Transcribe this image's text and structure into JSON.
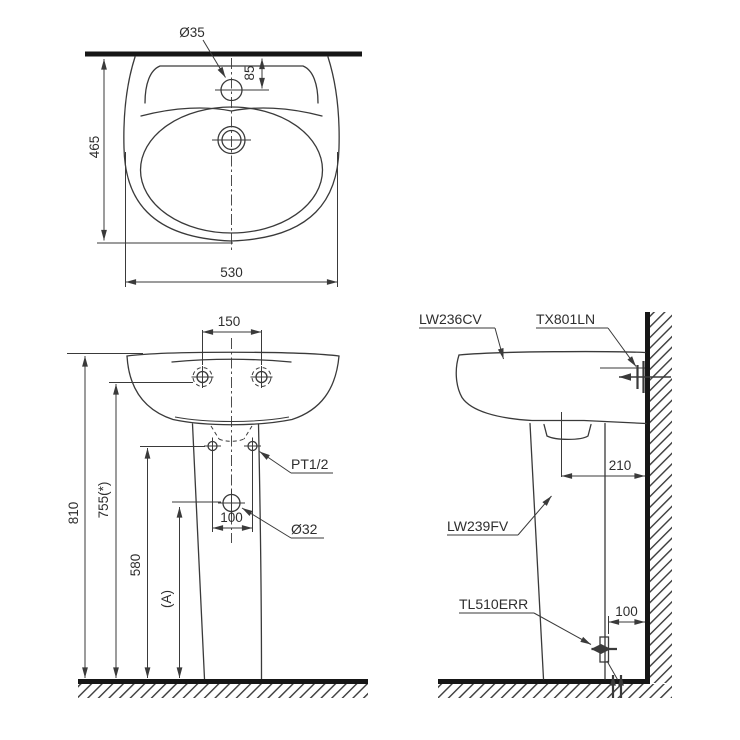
{
  "colors": {
    "line": "#3a3a3a",
    "heavy": "#161616",
    "text": "#2e2e2e",
    "background": "#ffffff"
  },
  "top_view": {
    "dim_faucet_hole_diameter": "Ø35",
    "dim_faucet_hole_to_wall": "85",
    "dim_basin_depth": "465",
    "dim_basin_width": "530"
  },
  "front_view": {
    "dim_hanger_bolt_spacing": "150",
    "label_supply_thread": "PT1/2",
    "dim_overall_height": "810",
    "dim_rim_height": "755(*)",
    "dim_supply_height": "580",
    "dim_drain_height": "(A)",
    "dim_supply_hole_spacing": "100",
    "label_drain_hole_diameter": "Ø32"
  },
  "side_view": {
    "label_lavatory_model": "LW236CV",
    "label_hanger_bolt_model": "TX801LN",
    "dim_drain_center_to_wall": "210",
    "label_pedestal_model": "LW239FV",
    "label_drain_set_model": "TL510ERR",
    "dim_outlet_to_wall": "100"
  }
}
